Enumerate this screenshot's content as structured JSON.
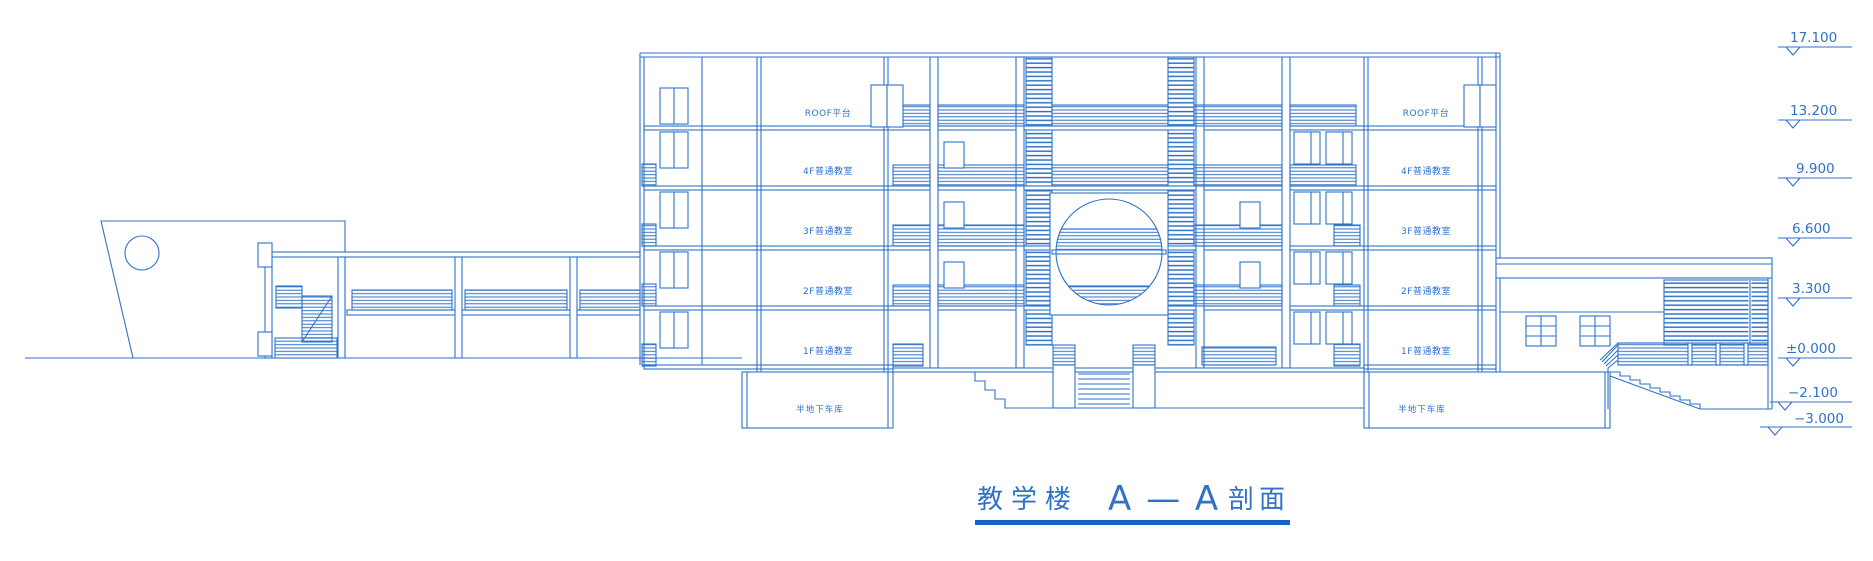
{
  "drawing_type": "architectural-section-cad-blueprint",
  "colors": {
    "line": "#2f72c8",
    "hatch": "#3c7ccd",
    "title_underline": "#1565c8",
    "background": "#ffffff"
  },
  "title": {
    "building": "教学楼",
    "section_mark": "A — A",
    "suffix": "剖面"
  },
  "floors": [
    {
      "label": "ROOF平台"
    },
    {
      "label": "4F普通教室"
    },
    {
      "label": "3F普通教室"
    },
    {
      "label": "2F普通教室"
    },
    {
      "label": "1F普通教室"
    },
    {
      "label": "半地下车库"
    }
  ],
  "elevations": [
    {
      "value": "17.100"
    },
    {
      "value": "13.200"
    },
    {
      "value": "9.900"
    },
    {
      "value": "6.600"
    },
    {
      "value": "3.300"
    },
    {
      "value": "±0.000"
    },
    {
      "value": "−2.100"
    },
    {
      "value": "−3.000"
    }
  ]
}
